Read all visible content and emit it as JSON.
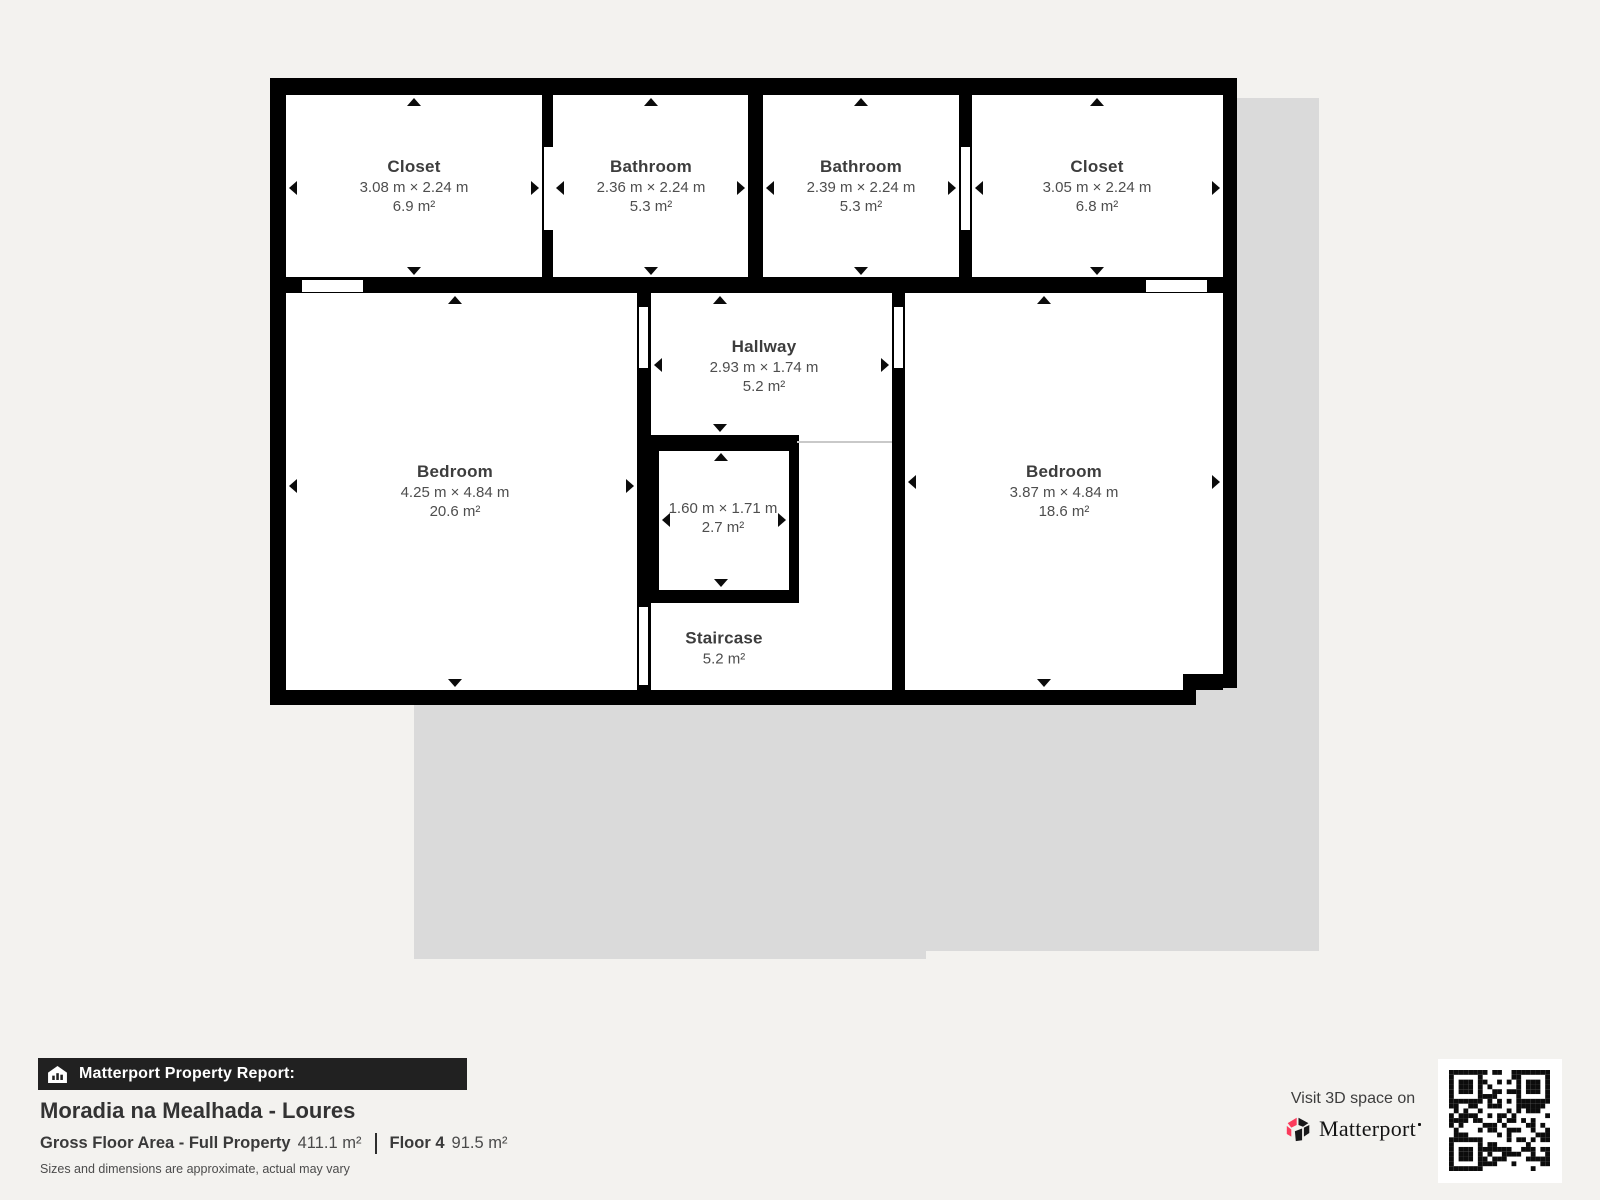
{
  "floorplan": {
    "rooms": [
      {
        "id": "closet-top-left",
        "title": "Closet",
        "dims": "3.08 m × 2.24 m",
        "area": "6.9 m²"
      },
      {
        "id": "bathroom-left",
        "title": "Bathroom",
        "dims": "2.36 m × 2.24 m",
        "area": "5.3 m²"
      },
      {
        "id": "bathroom-right",
        "title": "Bathroom",
        "dims": "2.39 m × 2.24 m",
        "area": "5.3 m²"
      },
      {
        "id": "closet-top-right",
        "title": "Closet",
        "dims": "3.05 m × 2.24 m",
        "area": "6.8 m²"
      },
      {
        "id": "bedroom-left",
        "title": "Bedroom",
        "dims": "4.25 m × 4.84 m",
        "area": "20.6 m²"
      },
      {
        "id": "hallway",
        "title": "Hallway",
        "dims": "2.93 m × 1.74 m",
        "area": "5.2 m²"
      },
      {
        "id": "shaft",
        "title": "",
        "dims": "1.60 m × 1.71 m",
        "area": "2.7 m²"
      },
      {
        "id": "staircase",
        "title": "Staircase",
        "dims": "",
        "area": "5.2 m²"
      },
      {
        "id": "bedroom-right",
        "title": "Bedroom",
        "dims": "3.87 m × 4.84 m",
        "area": "18.6 m²"
      }
    ]
  },
  "footer": {
    "report_label": "Matterport Property Report:",
    "property_title": "Moradia na Mealhada - Loures",
    "gfa_label": "Gross Floor Area - Full Property",
    "gfa_value": "411.1 m²",
    "floor_label": "Floor 4",
    "floor_value": "91.5 m²",
    "disclaimer": "Sizes and dimensions are approximate, actual may vary"
  },
  "cta": {
    "visit_text": "Visit 3D space on",
    "brand": "Matterport",
    "accent_color": "#fb3b5c",
    "dark_color": "#18181a"
  }
}
